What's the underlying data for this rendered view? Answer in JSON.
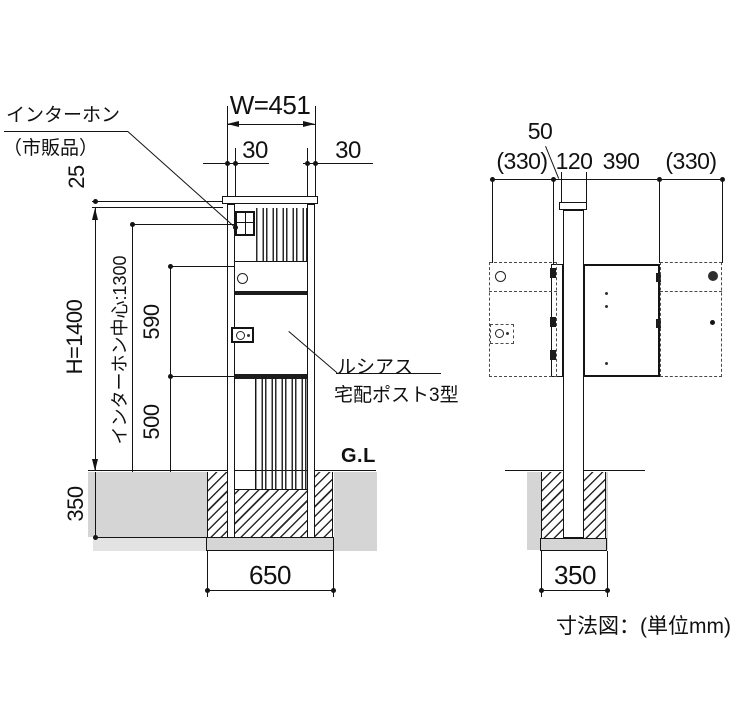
{
  "diagram": {
    "unit_caption": "寸法図：(単位mm)",
    "front": {
      "intercom_label_1": "インターホン",
      "intercom_label_2": "（市販品）",
      "width_label": "W=451",
      "margin_left": "30",
      "margin_right": "30",
      "cap_offset": "25",
      "height_label": "H=1400",
      "intercom_center_label": "インターホン中心:1300",
      "upper_span": "590",
      "lower_span": "500",
      "embed_depth": "350",
      "footing_width": "650",
      "ground_label": "G.L",
      "product_label_1": "ルシアス",
      "product_label_2": "宅配ポスト3型"
    },
    "side": {
      "top_offset": "50",
      "open_left": "(330)",
      "post_depth": "120",
      "box_depth": "390",
      "open_right": "(330)",
      "footing_width": "350"
    }
  }
}
